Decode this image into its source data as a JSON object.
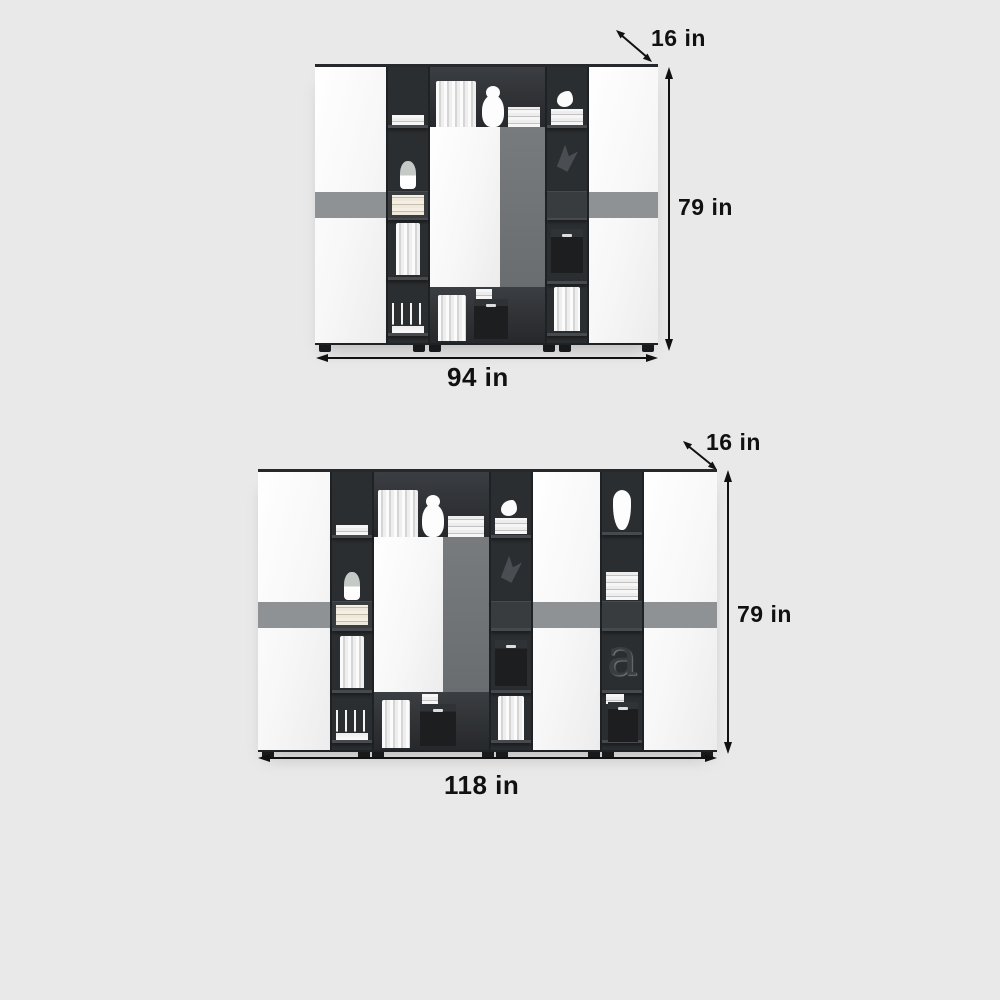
{
  "page": {
    "background_color": "#e9e9e9"
  },
  "colors": {
    "white_door": "#fbfbfb",
    "dark_panel": "#2b2e31",
    "accent_band": "#8f9294",
    "gray_door": "#717477",
    "dimension_text": "#111111"
  },
  "diagrams": [
    {
      "name": "bookcase 94 inch",
      "depth_label": "16 in",
      "height_label": "79 in",
      "width_label": "94 in",
      "decor_items": [
        "books",
        "stacked books",
        "teddy bear",
        "plant",
        "storage boxes",
        "candle holders",
        "bird figurine",
        "sculpture"
      ]
    },
    {
      "name": "bookcase 118 inch",
      "depth_label": "16 in",
      "height_label": "79 in",
      "width_label": "118 in",
      "decor_letter": "a",
      "decor_items": [
        "books",
        "stacked books",
        "teddy bear",
        "plant",
        "vase",
        "storage boxes",
        "candle holders",
        "bird figurine",
        "sculpture",
        "letter a"
      ]
    }
  ]
}
